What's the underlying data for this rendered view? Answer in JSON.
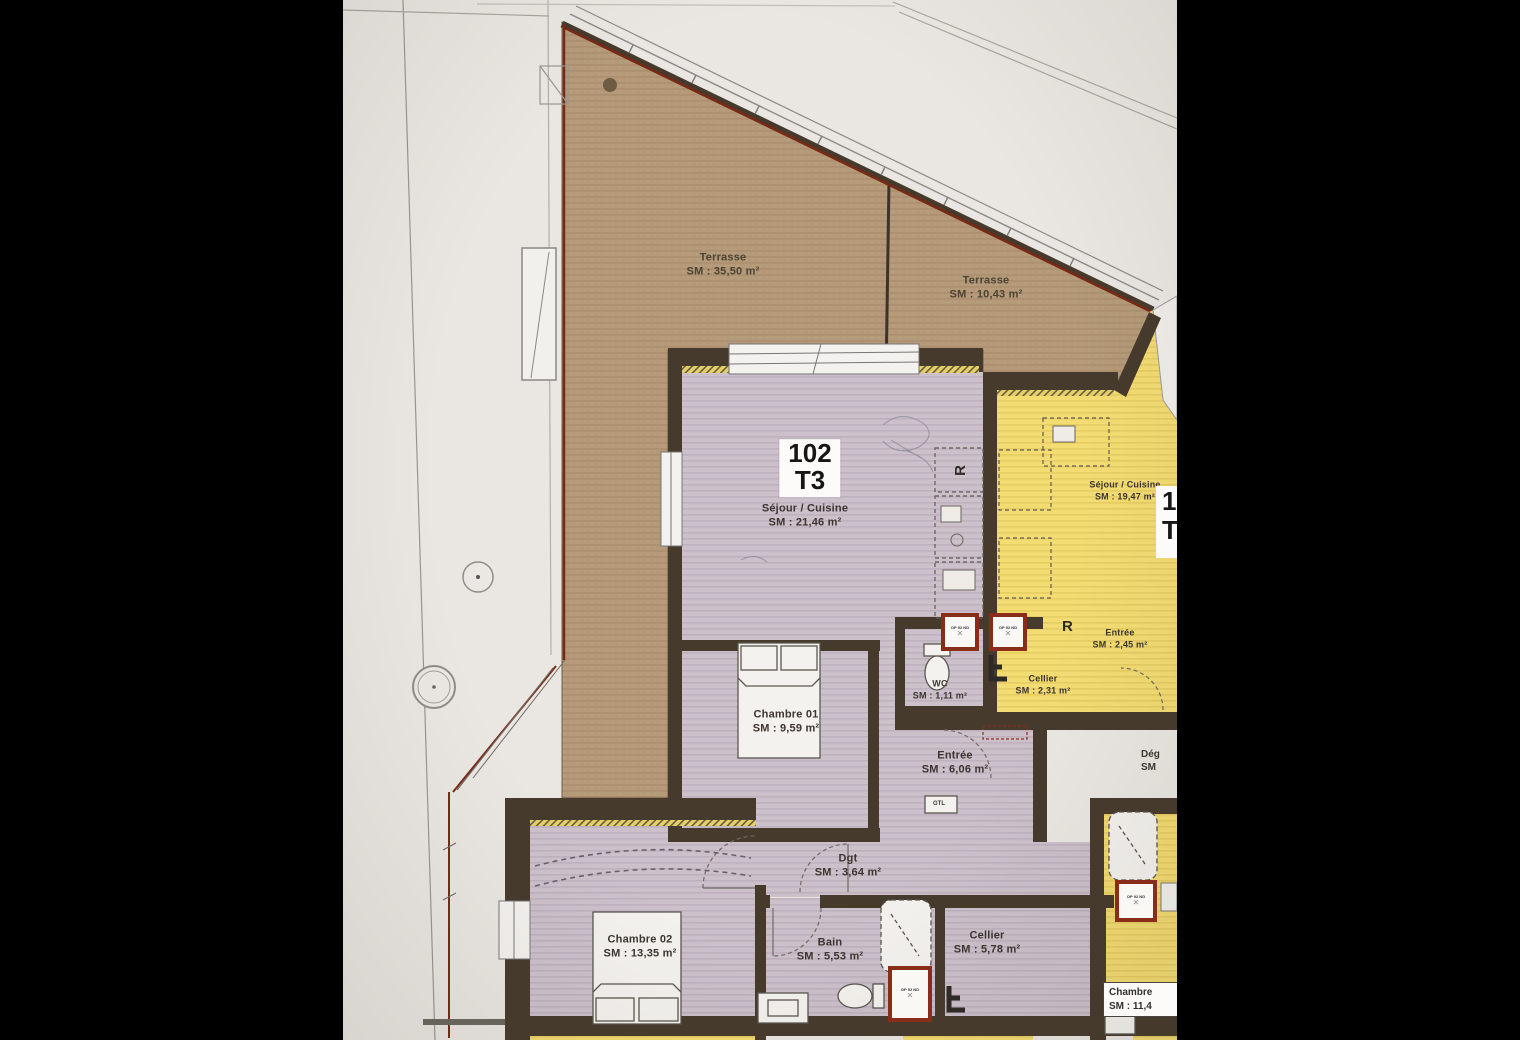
{
  "plan_title": "Floor plan photo — apartment 102 T3 with terraces",
  "terraces": [
    {
      "name": "Terrasse",
      "area": "SM : 35,50 m²"
    },
    {
      "name": "Terrasse",
      "area": "SM : 10,43 m²"
    }
  ],
  "apartment": {
    "number": "102",
    "type": "T3"
  },
  "rooms": [
    {
      "name": "Séjour / Cuisine",
      "area": "SM : 21,46 m²"
    },
    {
      "name": "Chambre 01",
      "area": "SM : 9,59 m²"
    },
    {
      "name": "WC",
      "area": "SM : 1,11 m²"
    },
    {
      "name": "Entrée",
      "area": "SM : 6,06 m²"
    },
    {
      "name": "Dgt",
      "area": "SM : 3,64 m²"
    },
    {
      "name": "Chambre 02",
      "area": "SM : 13,35 m²"
    },
    {
      "name": "Bain",
      "area": "SM : 5,53 m²"
    },
    {
      "name": "Cellier",
      "area": "SM : 5,78 m²"
    }
  ],
  "neighbor": {
    "number_partial": "10",
    "type_partial": "T",
    "rooms": [
      {
        "name": "Séjour / Cuisine",
        "area": "SM : 19,47 m²"
      },
      {
        "name": "Entrée",
        "area": "SM : 2,45 m²"
      },
      {
        "name": "Cellier",
        "area": "SM : 2,31 m²"
      }
    ]
  },
  "right_edge": {
    "degagement_name": "Dég",
    "degagement_area": "SM",
    "chambre_name": "Chambre",
    "chambre_area": "SM : 11,4"
  },
  "symbols": {
    "fridge": "R",
    "gtl": "GTL",
    "door_tag": "OP 92 ND",
    "cross": "✕"
  },
  "colors": {
    "terrace": "#b59a79",
    "apartment_floor": "#ccc0cb",
    "neighbor_floor": "#f3dc72",
    "wall": "#463a2c",
    "door_frame": "#8a2d18",
    "boundary_red": "#7b2815",
    "paper": "#eae7e2"
  }
}
